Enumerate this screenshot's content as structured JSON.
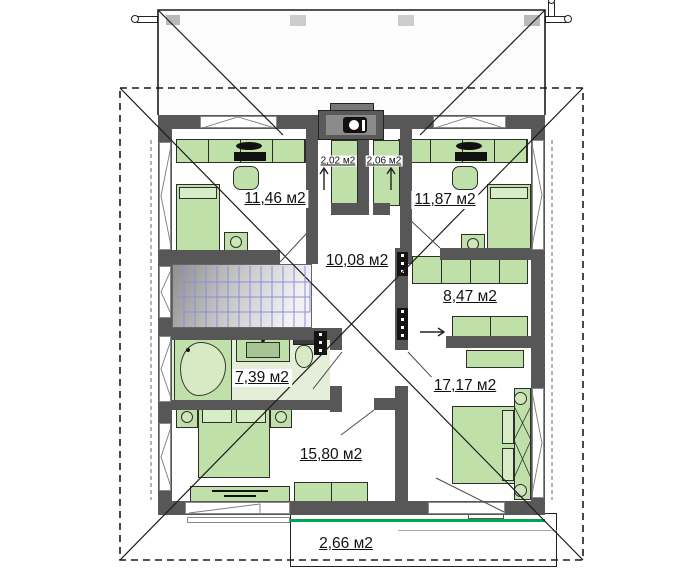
{
  "plan": {
    "type": "floor-plan",
    "area_unit": "м2",
    "rooms": [
      {
        "id": "bedroom-top-left",
        "area_label": "11,46 м2"
      },
      {
        "id": "bedroom-top-right",
        "area_label": "11,87 м2"
      },
      {
        "id": "closet-left",
        "area_label": "2,02 м2"
      },
      {
        "id": "closet-right",
        "area_label": "2,06 м2"
      },
      {
        "id": "hall",
        "area_label": "10,08 м2"
      },
      {
        "id": "walk-in-closet",
        "area_label": "8,47 м2"
      },
      {
        "id": "bathroom",
        "area_label": "7,39 м2"
      },
      {
        "id": "bedroom-right",
        "area_label": "17,17 м2"
      },
      {
        "id": "bedroom-left",
        "area_label": "15,80 м2"
      },
      {
        "id": "balcony",
        "area_label": "2,66 м2"
      }
    ],
    "colors": {
      "wall": "#575757",
      "furniture_fill": "#bfe0a8",
      "furniture_border": "#2e2e2e",
      "bathroom_floor": "#e4eed9",
      "stair_lines": "#8c8cdc",
      "balcony_accent_line": "#00a651",
      "roof_lines": "#1c1c1c"
    }
  }
}
